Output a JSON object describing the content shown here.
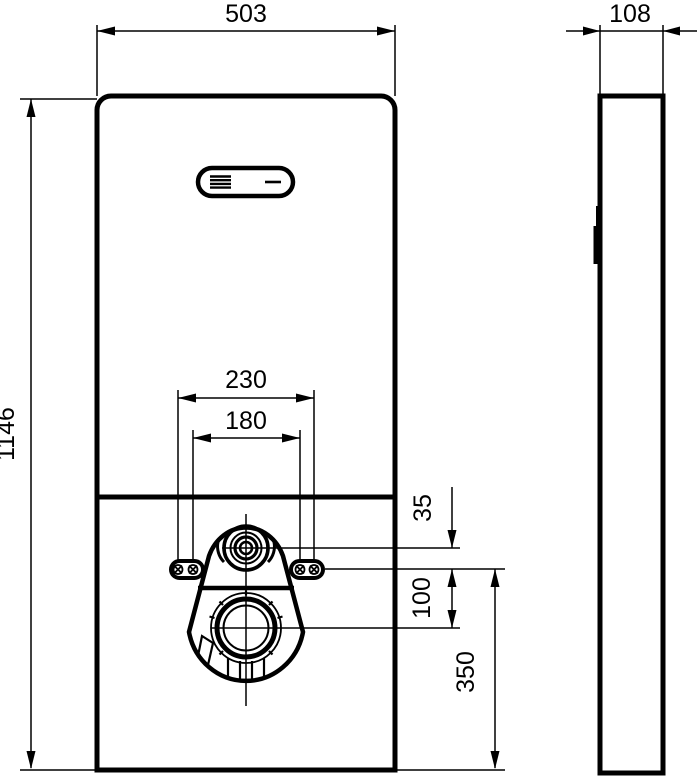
{
  "page": {
    "background_color": "#ffffff",
    "line_color": "#000000"
  },
  "drawing": {
    "type": "technical-dimension-drawing",
    "subject": "wall-hung sanitary flush module, front and side views",
    "unit": "mm"
  },
  "dimensions": {
    "front_width": "503",
    "front_height": "1146",
    "side_depth": "108",
    "fixing_spacing_outer": "230",
    "fixing_spacing_inner": "180",
    "inlet_to_fixing": "35",
    "fixing_to_outlet": "100",
    "fixing_height": "350"
  }
}
